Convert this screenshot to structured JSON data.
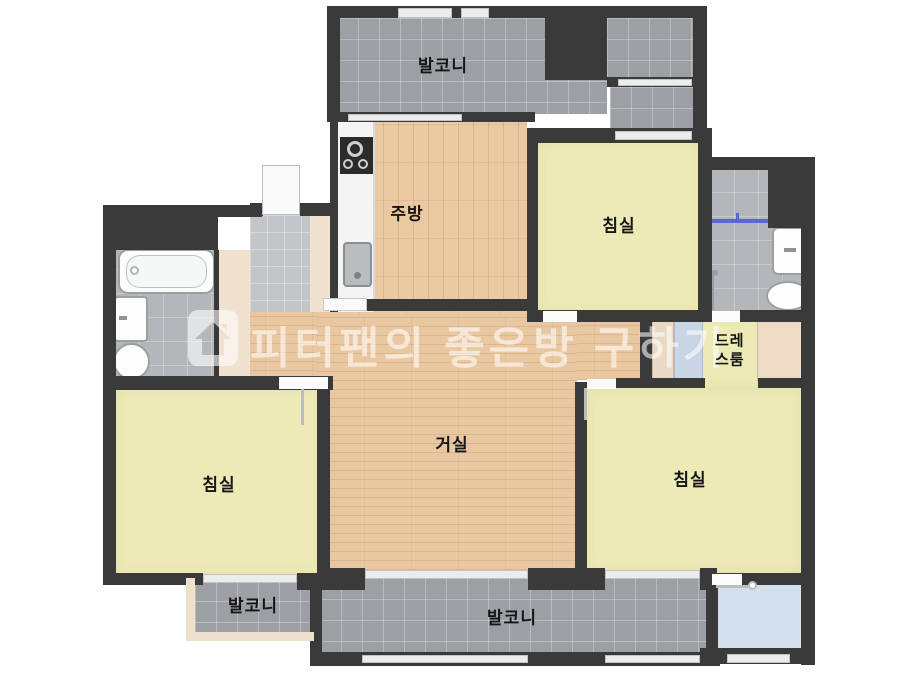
{
  "meta": {
    "type": "apartment-floor-plan",
    "width_px": 923,
    "height_px": 676
  },
  "rooms": {
    "balcony_top": {
      "label": "발코니"
    },
    "kitchen": {
      "label": "주방"
    },
    "bedroom_top_right": {
      "label": "침실"
    },
    "dressing_room": {
      "label": "드레스룸"
    },
    "living_room": {
      "label": "거실"
    },
    "bedroom_left": {
      "label": "침실"
    },
    "bedroom_right": {
      "label": "침실"
    },
    "balcony_bottom_left": {
      "label": "발코니"
    },
    "balcony_bottom": {
      "label": "발코니"
    }
  },
  "watermark": {
    "text": "피터팬의 좋은방 구하기",
    "logo": "peterpan-house-logo",
    "color": "#ffffff",
    "opacity": 0.58
  },
  "fixtures": [
    "bathtub",
    "sink",
    "toilet",
    "kitchen-counter",
    "stove",
    "kitchen-sink",
    "shower-rod",
    "shower-head",
    "wardrobe",
    "closet",
    "entrance-door"
  ],
  "colors": {
    "wall": "#3a3a3a",
    "wood_floor": "#ebc9a2",
    "bedroom_floor": "#edeab7",
    "balcony_tile": "#9c9fa4",
    "bathroom_tile": "#b4b7b9",
    "entry_tile": "#c3c6c8",
    "utility_room": "#d3dfec",
    "closet_beige": "#f0e2cf",
    "shower_rod_blue": "#5b68d2",
    "label_text": "#161616"
  }
}
